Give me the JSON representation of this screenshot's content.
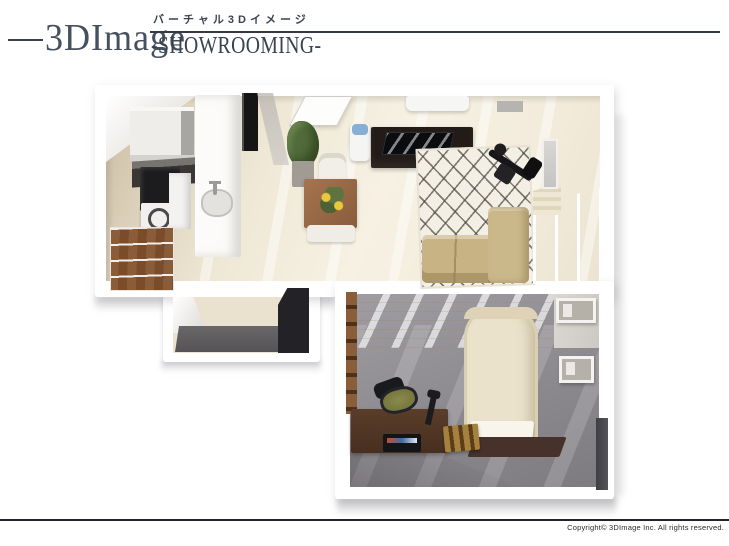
{
  "header": {
    "title": "3DImage",
    "subtitle_jp": "バーチャル3Dイメージ",
    "subtitle_en": "-SHOWROOMING-"
  },
  "footer": {
    "copyright": "Copyright© 3DImage Inc. All rights reserved."
  },
  "floor_plan": {
    "type": "3D bird's-eye apartment render (1LDK showroom)",
    "rooms": [
      {
        "id": "living-dining-kitchen",
        "floor_color": "#f2ecdd"
      },
      {
        "id": "bedroom",
        "floor_color": "#8b888d"
      },
      {
        "id": "entrance-hall",
        "floor_color": "#eae2cf"
      }
    ],
    "furniture": [
      "kitchen-upper-cabinet",
      "kitchen-counter",
      "refrigerator",
      "washing-machine",
      "wood-shelf",
      "island-counter",
      "sink",
      "tall-black-cabinet",
      "open-door",
      "potted-plant",
      "dining-table",
      "dining-chair-top",
      "dining-chair-bottom",
      "flower-arrangement",
      "water-server",
      "tv-lowboard",
      "television",
      "air-conditioner",
      "ceiling-vent",
      "lattice-rug",
      "exercise-bike",
      "sofa",
      "sofa-chaise",
      "balcony-window",
      "curtain",
      "wall-mirror",
      "accent-wall",
      "wall-ladder-rack",
      "bed",
      "bed-sheet",
      "bed-rug",
      "desk",
      "desk-chair",
      "laptop",
      "desk-lamp",
      "book-stool",
      "wall-shelf-box-1",
      "wall-shelf-box-2",
      "dark-niche",
      "genkan-floor",
      "open-closet"
    ],
    "colors": {
      "walls": "#ffffff",
      "ldk_floor": "#f2ecdd",
      "kitchen_counter": "#3a3734",
      "sofa": "#c7b383",
      "rug": "#f3efe5",
      "bedroom_carpet": "#8b888d",
      "bed": "#ebe2cb",
      "desk": "#4f3524",
      "accent_wall": "#eadfc8",
      "header_text": "#46505e"
    }
  }
}
